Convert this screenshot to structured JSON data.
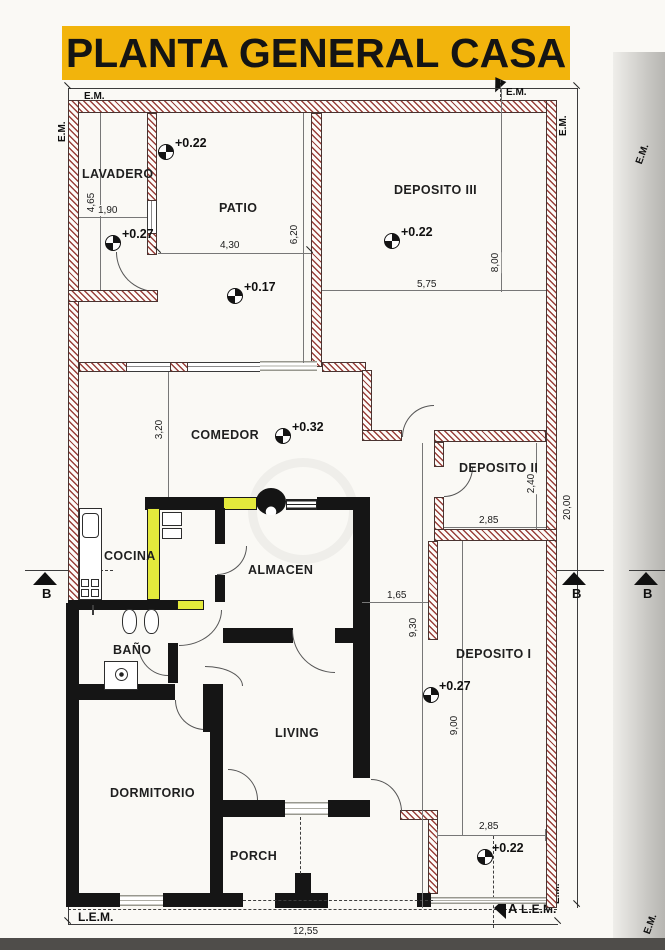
{
  "title": "PLANTA GENERAL CASA",
  "colors": {
    "banner": "#f2b40c",
    "new_wall_yellow": "#e4ea3c",
    "solid_wall": "#151515",
    "hatch_red": "#91302a"
  },
  "rooms": {
    "lavadero": "LAVADERO",
    "patio": "PATIO",
    "deposito3": "DEPOSITO III",
    "comedor": "COMEDOR",
    "deposito2": "DEPOSITO II",
    "cocina": "COCINA",
    "almacen": "ALMACEN",
    "bano": "BAÑO",
    "deposito1": "DEPOSITO I",
    "living": "LIVING",
    "dormitorio": "DORMITORIO",
    "porch": "PORCH"
  },
  "levels": {
    "patio_upper": "+0.22",
    "lavadero": "+0.27",
    "patio_lower": "+0.17",
    "deposito3": "+0.22",
    "comedor": "+0.32",
    "deposito1": "+0.27",
    "yard": "+0.22"
  },
  "dims": {
    "lavadero_h": "4,65",
    "lavadero_w": "1,90",
    "patio_w": "4,30",
    "patio_h": "6,20",
    "dep3_w": "5,75",
    "dep3_h": "8,00",
    "comedor_h": "3,20",
    "dep2_w": "2,85",
    "dep2_h": "2,40",
    "corridor_w": "1,65",
    "dep1_h_a": "9,30",
    "dep1_h_b": "9,00",
    "lot_h": "20,00",
    "yard_w": "2,85",
    "lot_w": "12,55"
  },
  "markers": {
    "em": "E.M.",
    "lem": "L.E.M.",
    "section_a": "A",
    "section_b": "B"
  }
}
